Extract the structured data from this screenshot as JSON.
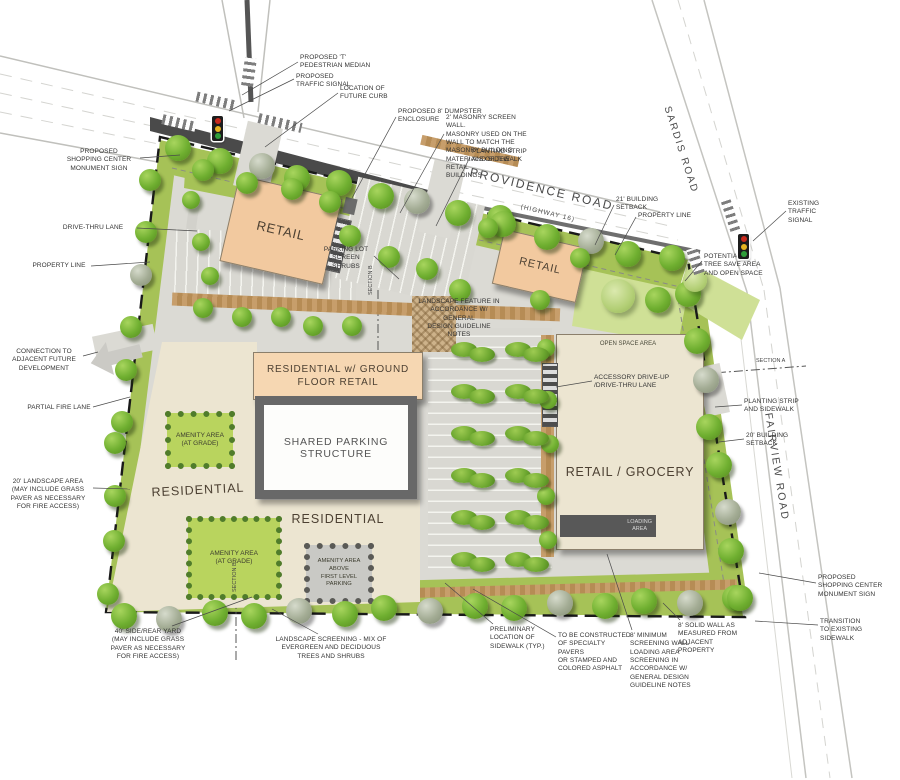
{
  "site_plan": {
    "roads": {
      "providence": {
        "label": "PROVIDENCE ROAD",
        "sub": "(HIGHWAY 16)"
      },
      "sardis": {
        "label": "SARDIS ROAD"
      },
      "fairview": {
        "label": "FAIRVIEW ROAD"
      }
    },
    "buildings": {
      "retail_nw": {
        "label": "RETAIL"
      },
      "retail_ne": {
        "label": "RETAIL"
      },
      "residential_ground_retail": {
        "label": "RESIDENTIAL w/ GROUND FLOOR RETAIL"
      },
      "shared_parking": {
        "label": "SHARED PARKING STRUCTURE"
      },
      "residential_west": {
        "label": "RESIDENTIAL"
      },
      "residential_south": {
        "label": "RESIDENTIAL"
      },
      "retail_grocery": {
        "label": "RETAIL / GROCERY"
      },
      "loading_area": {
        "label": "LOADING\nAREA"
      }
    },
    "areas": {
      "amenity_nw": {
        "label": "AMENITY AREA\n(AT GRADE)"
      },
      "amenity_sw": {
        "label": "AMENITY AREA\n(AT GRADE)"
      },
      "amenity_above": {
        "label": "AMENITY AREA\nABOVE\nFIRST LEVEL\nPARKING"
      },
      "open_space": {
        "label": "OPEN SPACE AREA"
      }
    },
    "section_markers": {
      "a": "SECTION A",
      "b": "SECTION B"
    },
    "callouts": [
      {
        "id": "monument_nw",
        "text": "PROPOSED\nSHOPPING CENTER\nMONUMENT SIGN"
      },
      {
        "id": "drive_thru",
        "text": "DRIVE-THRU LANE"
      },
      {
        "id": "property_line_w",
        "text": "PROPERTY LINE"
      },
      {
        "id": "connection",
        "text": "CONNECTION TO\nADJACENT FUTURE\nDEVELOPMENT"
      },
      {
        "id": "partial_fire",
        "text": "PARTIAL FIRE LANE"
      },
      {
        "id": "landscape20",
        "text": "20' LANDSCAPE AREA\n(MAY INCLUDE GRASS\nPAVER AS NECESSARY\nFOR FIRE ACCESS)"
      },
      {
        "id": "sideyard40",
        "text": "40' SIDE/REAR YARD\n(MAY INCLUDE GRASS\nPAVER AS NECESSARY\nFOR FIRE ACCESS)"
      },
      {
        "id": "landscape_screening",
        "text": "LANDSCAPE SCREENING - MIX OF\nEVERGREEN AND DECIDUOUS\nTREES AND SHRUBS"
      },
      {
        "id": "t_median",
        "text": "PROPOSED 'T'\nPEDESTRIAN MEDIAN"
      },
      {
        "id": "traffic_signal",
        "text": "PROPOSED\nTRAFFIC SIGNAL"
      },
      {
        "id": "future_curb",
        "text": "LOCATION OF\nFUTURE CURB"
      },
      {
        "id": "dumpster",
        "text": "PROPOSED 8' DUMPSTER\nENCLOSURE"
      },
      {
        "id": "masonry_wall",
        "text": "2' MASONRY SCREEN WALL.\nMASONRY USED ON THE\nWALL TO MATCH THE\nMASONRY BUILDING\nMATERIALS OF THE RETAIL\nBUILDINGS"
      },
      {
        "id": "planting_top",
        "text": "PLANTING STRIP\nAND SIDEWALK"
      },
      {
        "id": "setback21",
        "text": "21' BUILDING\nSETBACK"
      },
      {
        "id": "property_line_e",
        "text": "PROPERTY LINE"
      },
      {
        "id": "existing_signal",
        "text": "EXISTING\nTRAFFIC\nSIGNAL"
      },
      {
        "id": "tree_save",
        "text": "POTENTIAL\nTREE SAVE AREA\nAND OPEN SPACE"
      },
      {
        "id": "planting_right",
        "text": "PLANTING STRIP\nAND SIDEWALK"
      },
      {
        "id": "setback20_right",
        "text": "20' BUILDING\nSETBACK"
      },
      {
        "id": "monument_se",
        "text": "PROPOSED\nSHOPPING CENTER\nMONUMENT SIGN"
      },
      {
        "id": "transition",
        "text": "TRANSITION\nTO EXISTING\nSIDEWALK"
      },
      {
        "id": "sidewalk_typ",
        "text": "PRELIMINARY\nLOCATION OF\nSIDEWALK (TYP.)"
      },
      {
        "id": "pavers_note",
        "text": "TO BE CONSTRUCTED\nOF SPECIALTY PAVERS\nOR STAMPED AND\nCOLORED ASPHALT"
      },
      {
        "id": "screening8",
        "text": "8' MINIMUM\nSCREENING WALL\nLOADING AREA\nSCREENING IN\nACCORDANCE W/\nGENERAL DESIGN\nGUIDELINE NOTES"
      },
      {
        "id": "solidwall8",
        "text": "8' SOLID WALL AS\nMEASURED FROM\nADJACENT PROPERTY"
      },
      {
        "id": "parking_screen",
        "text": "PARKING LOT\nSCREEN SHRUBS"
      },
      {
        "id": "landscape_feature",
        "text": "LANDSCAPE FEATURE IN\nACCORDANCE W/ GENERAL\nDESIGN GUIDELINE NOTES"
      },
      {
        "id": "accessory",
        "text": "ACCESSORY DRIVE-UP\n/DRIVE-THRU LANE"
      }
    ],
    "palette": {
      "building_retail": "#f2c99f",
      "building_cream": "#ece5d1",
      "amenity_green": "#b9d45e",
      "landscape_green": "#a6c257",
      "parking_grey": "#d9d8d2",
      "paver_tan": "#c79e6b",
      "property_line": "#1a1a1a"
    }
  }
}
